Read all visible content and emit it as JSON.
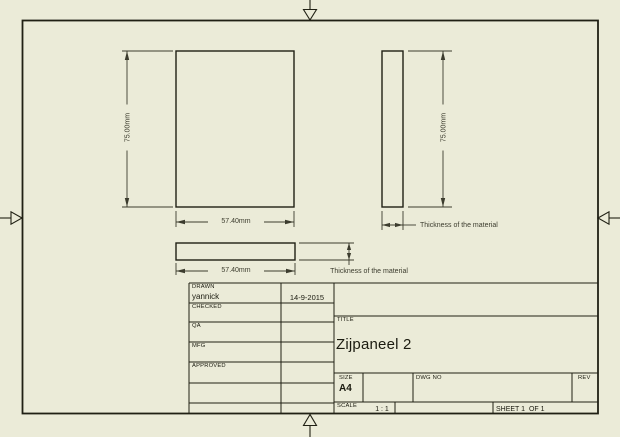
{
  "colors": {
    "background": "#ebebd8",
    "line": "#202014",
    "dimension": "#3c3c2e",
    "text": "#1b1b10"
  },
  "drawing": {
    "front_view": {
      "height_dim": "75.00mm",
      "width_dim": "57.40mm"
    },
    "side_view": {
      "height_dim": "75.00mm",
      "thickness_note": "Thickness of the material"
    },
    "bottom_view": {
      "width_dim": "57.40mm",
      "thickness_note": "Thickness of the material"
    }
  },
  "title_block": {
    "rows": [
      {
        "label": "DRAWN",
        "value": "yannick",
        "date": "14-9-2015"
      },
      {
        "label": "CHECKED",
        "value": "",
        "date": ""
      },
      {
        "label": "QA",
        "value": "",
        "date": ""
      },
      {
        "label": "MFG",
        "value": "",
        "date": ""
      },
      {
        "label": "APPROVED",
        "value": "",
        "date": ""
      }
    ],
    "title_label": "TITLE",
    "title_value": "Zijpaneel 2",
    "size_label": "SIZE",
    "size_value": "A4",
    "dwg_no_label": "DWG NO",
    "rev_label": "REV",
    "scale_label": "SCALE",
    "scale_value": "1 : 1",
    "sheet_label": "SHEET 1  OF 1"
  }
}
